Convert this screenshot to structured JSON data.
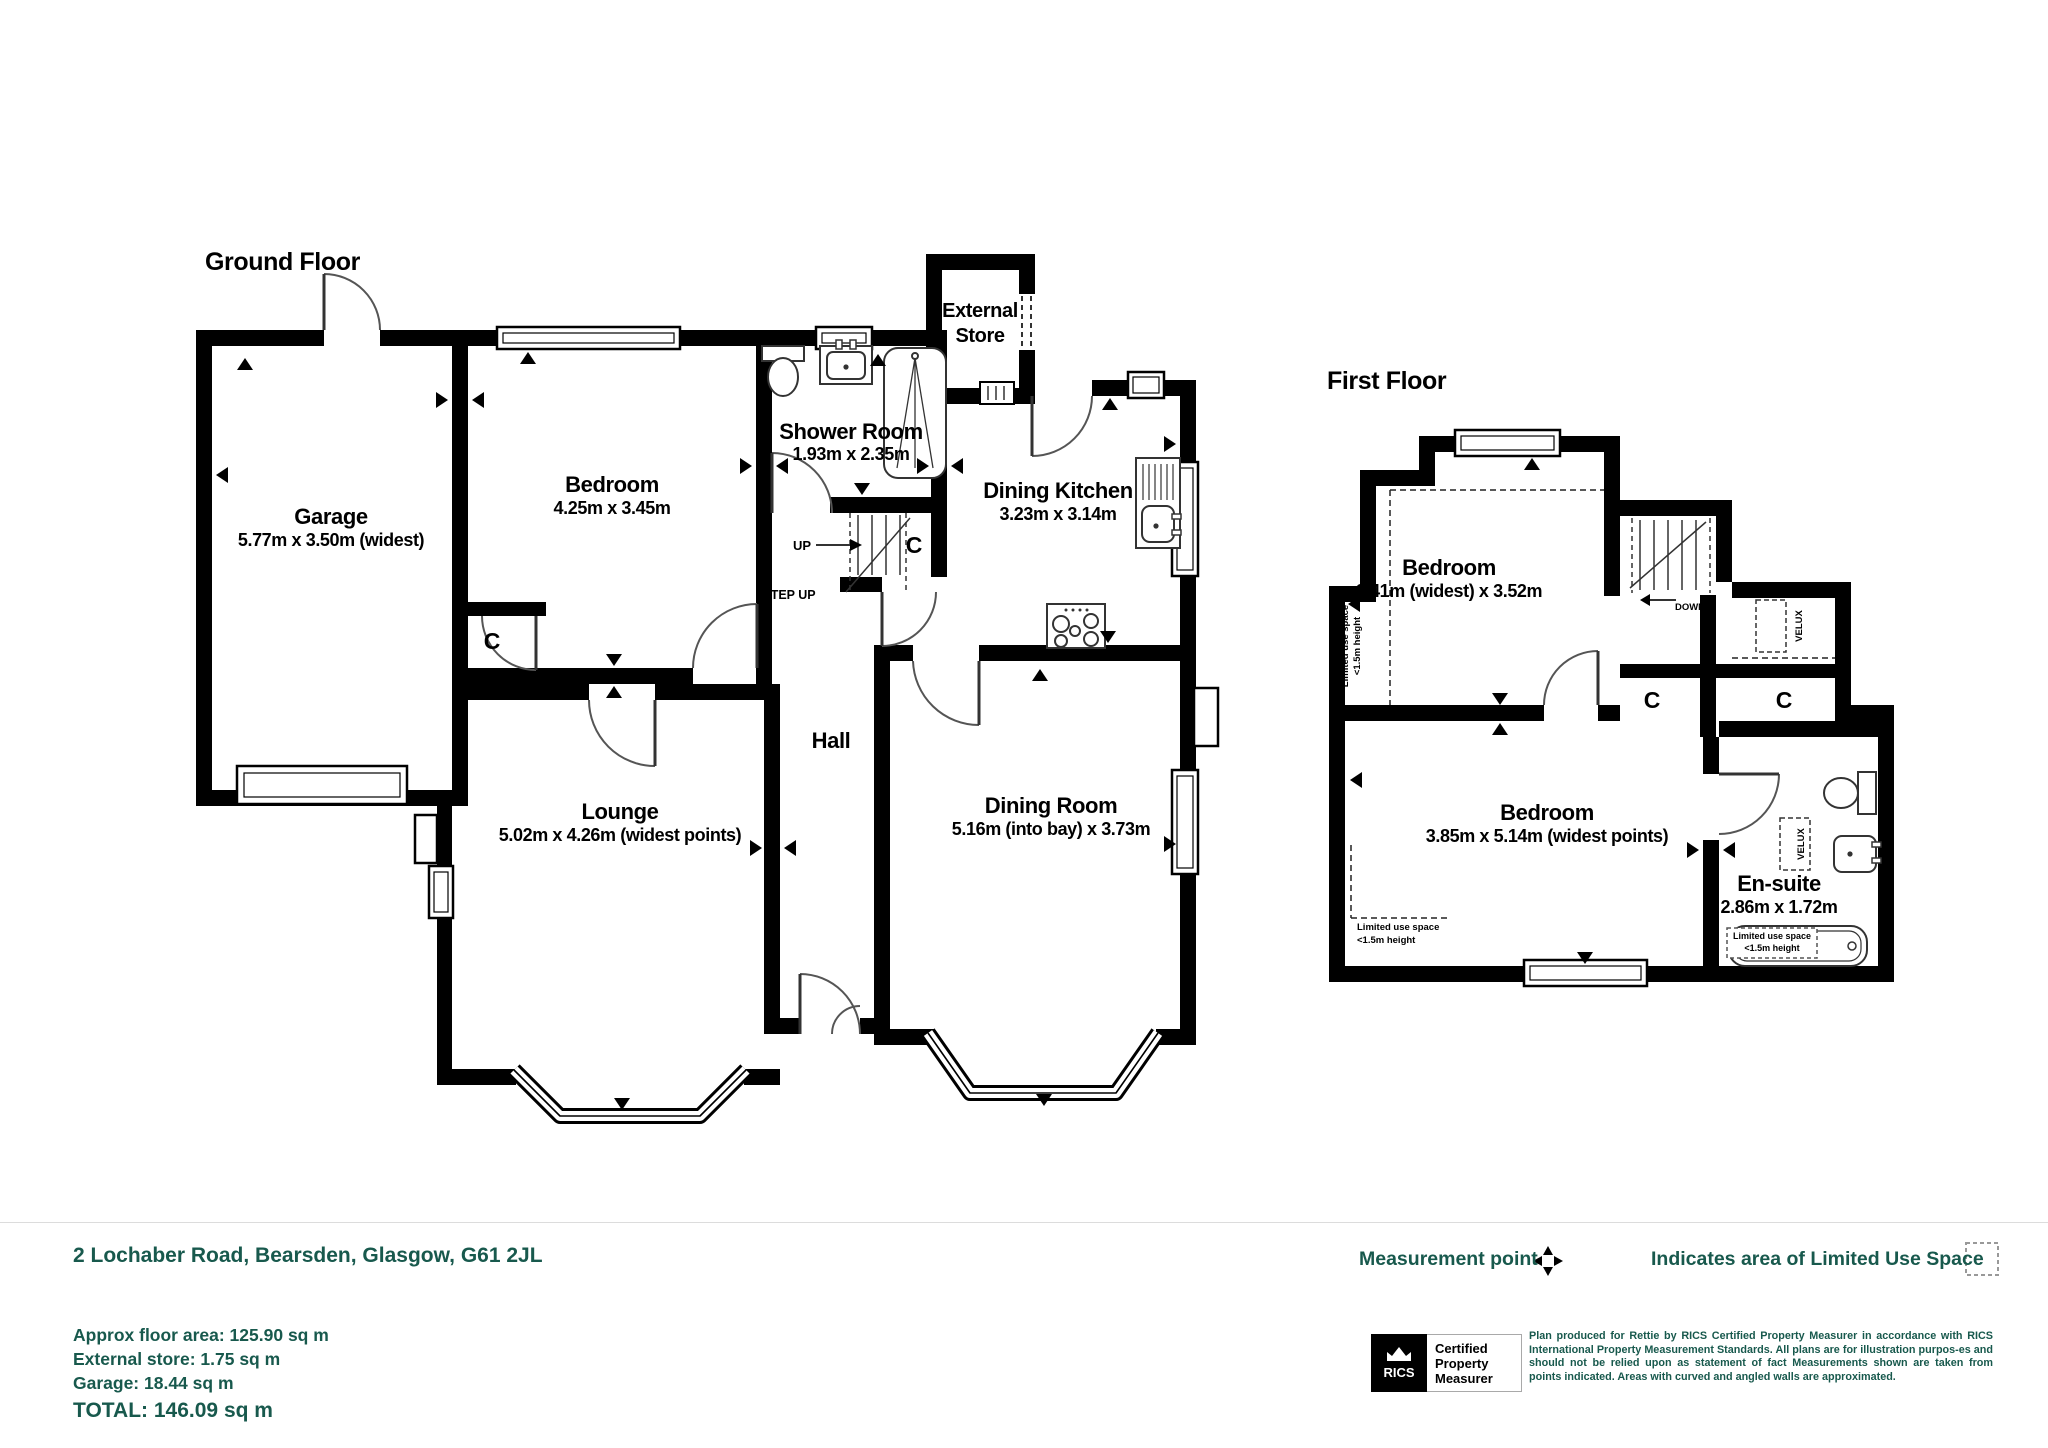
{
  "page": {
    "background": "#ffffff",
    "accent_color": "#18594d",
    "plan_color": "#000000"
  },
  "ground_floor": {
    "title": "Ground Floor",
    "rooms": {
      "garage": {
        "name": "Garage",
        "dims": "5.77m x 3.50m (widest)"
      },
      "bedroom": {
        "name": "Bedroom",
        "dims": "4.25m x 3.45m"
      },
      "shower_room": {
        "name": "Shower Room",
        "dims": "1.93m x 2.35m"
      },
      "external_store": {
        "name_line1": "External",
        "name_line2": "Store"
      },
      "dining_kitchen": {
        "name": "Dining Kitchen",
        "dims": "3.23m x 3.14m"
      },
      "hall": {
        "name": "Hall"
      },
      "lounge": {
        "name": "Lounge",
        "dims": "5.02m x 4.26m (widest points)"
      },
      "dining_room": {
        "name": "Dining Room",
        "dims": "5.16m (into bay) x 3.73m"
      }
    },
    "annotations": {
      "up": "UP",
      "step_up": "STEP UP",
      "cupboard": "C"
    }
  },
  "first_floor": {
    "title": "First Floor",
    "rooms": {
      "bedroom_front": {
        "name": "Bedroom",
        "dims": "3.41m (widest) x 3.52m"
      },
      "bedroom_rear": {
        "name": "Bedroom",
        "dims": "3.85m x 5.14m (widest points)"
      },
      "ensuite": {
        "name": "En-suite",
        "dims": "2.86m x 1.72m"
      }
    },
    "annotations": {
      "down": "DOWN",
      "velux": "VELUX",
      "cupboard": "C",
      "limited_use_line1": "Limited use space",
      "limited_use_line2": "<1.5m height"
    }
  },
  "footer": {
    "address": "2 Lochaber Road, Bearsden, Glasgow, G61 2JL",
    "legend": {
      "measurement_point": "Measurement point",
      "limited_use": "Indicates area of  Limited Use Space"
    },
    "areas": {
      "floor_area": "Approx floor area: 125.90 sq m",
      "external_store": "External store: 1.75 sq m",
      "garage": "Garage: 18.44 sq m",
      "total": "TOTAL: 146.09 sq m"
    },
    "rics_badge": {
      "brand": "RICS",
      "line1": "Certified",
      "line2": "Property",
      "line3": "Measurer"
    },
    "disclaimer": "Plan produced for Rettie by RICS Certified Property Measurer in accordance with RICS International Property  Measurement Standards.  All plans are for illustration purpos-es and should not be relied upon as statement of fact Measurements shown are taken from points indicated. Areas with curved and angled walls are approximated."
  }
}
